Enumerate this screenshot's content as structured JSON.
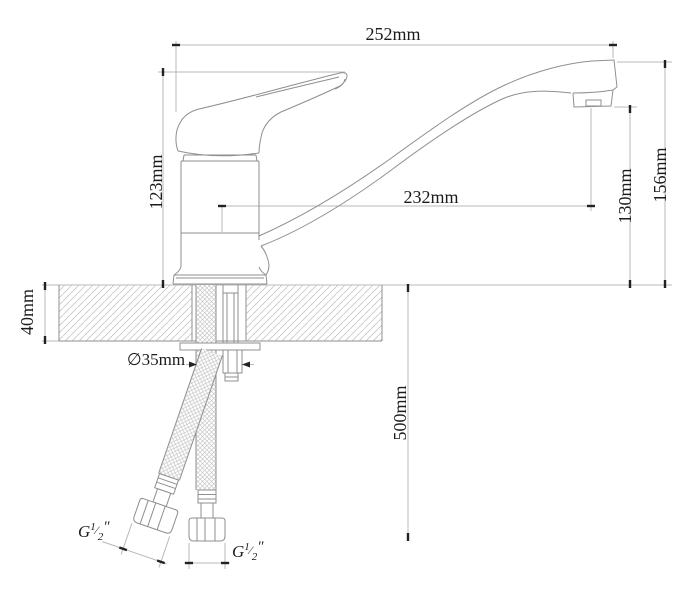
{
  "drawing": {
    "dimensions": {
      "overall_length": "252mm",
      "body_height": "123mm",
      "spout_reach": "232mm",
      "outlet_height": "130mm",
      "total_height": "156mm",
      "countertop_thickness": "40mm",
      "mounting_hole_diameter": "∅35mm",
      "hose_length": "500mm"
    },
    "thread_labels": {
      "left": {
        "base": "G",
        "numerator": "1",
        "fraction_slash": "⁄",
        "denominator": "2",
        "unit_mark": "″"
      },
      "right": {
        "base": "G",
        "numerator": "1",
        "fraction_slash": "⁄",
        "denominator": "2",
        "unit_mark": "″"
      }
    },
    "colors": {
      "background": "#ffffff",
      "outline": "#8f8f8f",
      "dimension_line": "#b8b8b8",
      "hatch": "#c9c9c9",
      "braid": "#bdbdbd",
      "tick": "#222222",
      "text": "#1b1b1b"
    }
  }
}
